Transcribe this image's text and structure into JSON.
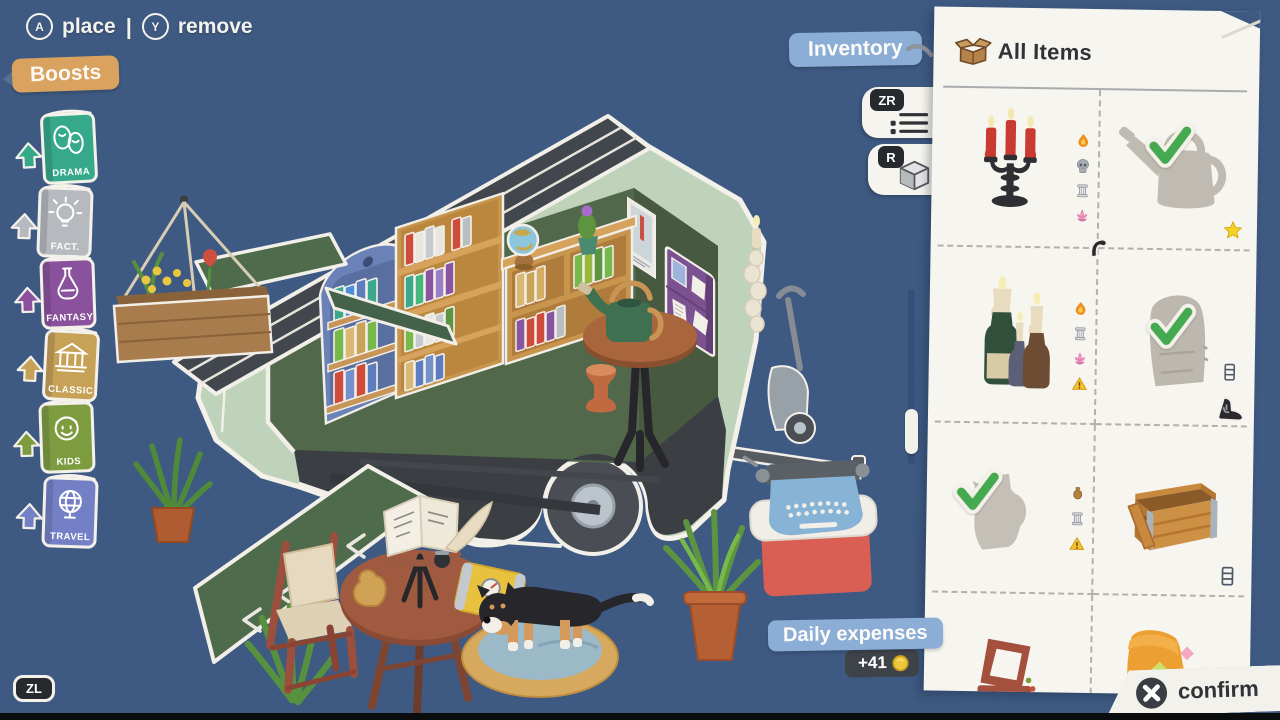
{
  "hud": {
    "a_button": "A",
    "a_label": "place",
    "separator": "|",
    "y_button": "Y",
    "y_label": "remove",
    "boosts_label": "Boosts",
    "inventory_label": "Inventory",
    "zr_button": "ZR",
    "r_button": "R",
    "zl_button": "ZL",
    "daily_expenses_label": "Daily expenses",
    "expense_delta": "+41",
    "confirm_button": "X",
    "confirm_label": "confirm"
  },
  "boosts": {
    "items": [
      {
        "label": "DRAMA",
        "icon": "drama-masks",
        "color": "#35a98a"
      },
      {
        "label": "FACT.",
        "icon": "lightbulb",
        "color": "#b6babf"
      },
      {
        "label": "FANTASY",
        "icon": "potion",
        "color": "#8a519c"
      },
      {
        "label": "CLASSIC",
        "icon": "temple",
        "color": "#c6a156"
      },
      {
        "label": "KIDS",
        "icon": "kid-face",
        "color": "#7d9c40"
      },
      {
        "label": "TRAVEL",
        "icon": "globe",
        "color": "#7480c5"
      }
    ]
  },
  "inventory_panel": {
    "title": "All Items",
    "title_icon": "box-icon",
    "items": [
      {
        "name": "candelabra",
        "placed": false,
        "badges": [
          "flame",
          "skull",
          "column",
          "lotus"
        ],
        "corners": []
      },
      {
        "name": "watering-can",
        "placed": true,
        "badges": [],
        "corners": [
          {
            "icon": "star",
            "pos": "br"
          }
        ]
      },
      {
        "name": "bottle-candles",
        "placed": false,
        "badges": [
          "flame",
          "column",
          "lotus",
          "warning"
        ],
        "corners": []
      },
      {
        "name": "wardrobe-door",
        "placed": true,
        "badges": [],
        "corners": [
          {
            "icon": "hook",
            "pos": "tl"
          },
          {
            "icon": "drawers",
            "pos": "br-upper"
          },
          {
            "icon": "boot",
            "pos": "br"
          }
        ]
      },
      {
        "name": "pitcher",
        "placed": true,
        "badges": [
          "vase",
          "column",
          "warning"
        ],
        "corners": []
      },
      {
        "name": "crate",
        "placed": false,
        "badges": [],
        "corners": [
          {
            "icon": "drawers",
            "pos": "br"
          }
        ]
      },
      {
        "name": "chair",
        "placed": false,
        "badges": [],
        "corners": []
      },
      {
        "name": "slipper",
        "placed": false,
        "badges": [],
        "corners": []
      }
    ]
  },
  "scene": {
    "description": "Cutaway green book-trailer with bookshelves, reading table, dog on cushion, plants, typewriter on cooler"
  },
  "colors": {
    "background": "#3e5a82",
    "panel": "#f7f5ef",
    "chip_blue": "#8cadd5",
    "tag_orange": "#d9a25f",
    "badge_dark": "#3e4349",
    "coin_gold": "#edc73c",
    "check_green": "#44a94f"
  }
}
